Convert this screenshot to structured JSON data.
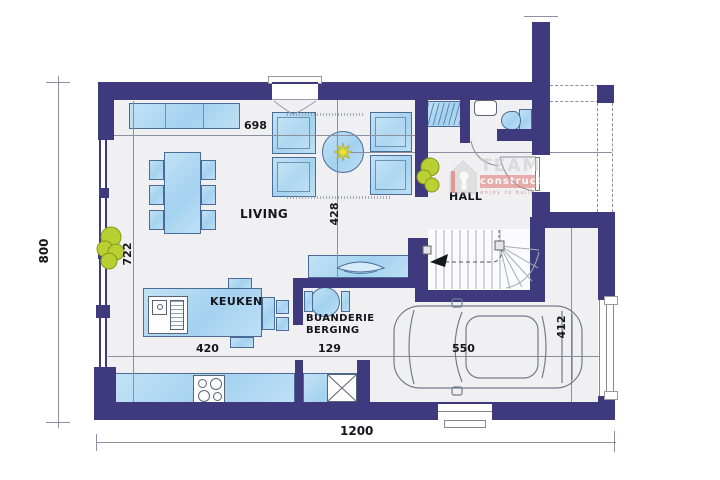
{
  "plan": {
    "rooms": {
      "living": "LIVING",
      "hall": "HALL",
      "kitchen": "KEUKEN",
      "laundry_line1": "BUANDERIE",
      "laundry_line2": "BERGING"
    },
    "dimensions": {
      "overall_width": "1200",
      "overall_height": "800",
      "living_width": "698",
      "living_depth": "428",
      "left_side": "722",
      "kitchen_width": "420",
      "laundry_width": "129",
      "garage_length": "550",
      "garage_depth": "412"
    }
  },
  "watermark": {
    "brand_top": "TEAM",
    "brand_bottom": "construct",
    "tagline": "enjoy to build"
  },
  "colors": {
    "wall_navy": "#3e3a7d",
    "furniture_blue": "#aed6f0",
    "floor": "#f0f0f3",
    "bush_green": "#b8cf2f",
    "star_yellow": "#e9e338",
    "logo_red": "#e28079"
  }
}
